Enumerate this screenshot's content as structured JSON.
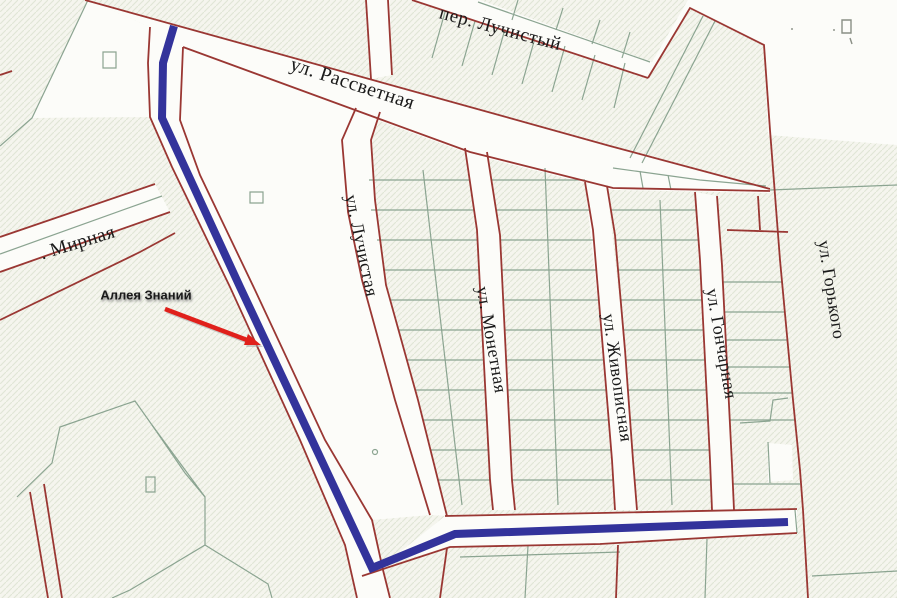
{
  "map": {
    "width": 897,
    "height": 598,
    "colors": {
      "background": "#f5f5ee",
      "hatch": "#e0e6d6",
      "parcel_fill": "#fcfcf9",
      "street_line": "#9a3733",
      "parcel_line": "#8ba491",
      "route": "#33339b",
      "arrow": "#e0201b",
      "arrow_shadow": "#a8a8a8",
      "label": "#1a1a1a"
    },
    "street_labels": [
      {
        "id": "per-luchistyy",
        "text": "пер. Лучистый",
        "x": 500,
        "y": 30,
        "rotation": 15,
        "size": 19
      },
      {
        "id": "ul-rassvetnaya",
        "text": "ул. Рассветная",
        "x": 352,
        "y": 85,
        "rotation": 18,
        "size": 20
      },
      {
        "id": "ul-mirnaya",
        "text": ". Мирная",
        "x": 78,
        "y": 244,
        "rotation": -17,
        "size": 19
      },
      {
        "id": "ul-luchistaya",
        "text": "ул. Лучистая",
        "x": 360,
        "y": 246,
        "rotation": 78,
        "size": 18
      },
      {
        "id": "ul-monetnaya",
        "text": "ул. Монетная",
        "x": 490,
        "y": 340,
        "rotation": 80,
        "size": 18
      },
      {
        "id": "ul-zhivopisnaya",
        "text": "ул. Живописная",
        "x": 616,
        "y": 378,
        "rotation": 82,
        "size": 18
      },
      {
        "id": "ul-goncharnaya",
        "text": "ул. Гончарная",
        "x": 720,
        "y": 344,
        "rotation": 80,
        "size": 18
      },
      {
        "id": "ul-gorkogo",
        "text": "ул. Горького",
        "x": 830,
        "y": 290,
        "rotation": 81,
        "size": 18
      }
    ],
    "annotation": {
      "text": "Аллея Знаний",
      "x": 146,
      "y": 296,
      "size": 13
    },
    "arrow": {
      "line": {
        "x1": 165,
        "y1": 309,
        "x2": 247,
        "y2": 340
      },
      "head": "261,345 244,345 248,334",
      "shadow_line": {
        "x1": 167,
        "y1": 311,
        "x2": 249,
        "y2": 342
      },
      "shadow_head": "263,347 246,347 250,336"
    },
    "route": {
      "name": "Аллея Знаний",
      "width": 8,
      "points": "174,26 163,63 162,118 240,287 312,440 372,568 455,534 788,522"
    },
    "white_areas": [
      "85,0 470,107 610,146 770,189 770,193 613,190 470,154 183,49 150,27 88,0",
      "150,27 148,63 150,117 172,167 230,287 300,440 345,545 357,598 390,598 383,570 372,520 325,440 255,290 200,175 180,120 183,47",
      "183,49 355,110 342,140 348,212 362,280 395,400 430,515 372,520 325,440 255,290 200,175 180,120",
      "356,108 380,112 371,140 375,200 386,285 418,400 447,516 430,515 395,400 362,280 348,212 342,140",
      "465,148 487,152 500,235 515,510 493,510 477,230",
      "585,182 607,186 625,350 637,510 615,510 603,350",
      "695,192 717,196 728,385 734,510 712,510 706,380",
      "652,62 688,0 897,0 897,145 768,135 764,45 690,8 648,78",
      "412,0 480,0 652,62 648,78",
      "445,516 600,513 797,509 797,533 720,537 600,544 450,547 385,565 375,572",
      "0,237 155,184 170,212 0,272",
      "88,0 150,27 148,63 150,117 32,118",
      "366,0 390,0 392,75 371,79",
      "768,443 792,445 793,480 768,482"
    ],
    "street_lines": [
      "M412,0 L648,78",
      "M648,78 L690,8 L764,45 L770,130 L780,260 L793,400 L800,470 L803,510 L808,598",
      "M85,0 L193,30 L470,107 L610,146 L770,189",
      "M183,47 L355,110 L470,152 L613,188 L770,191",
      "M150,27 L148,63 L150,117 L172,167 L230,287 L300,440 L345,545 L357,598",
      "M183,47 L180,120 L200,175 L255,290 L325,440 L372,520 L383,570 L390,598",
      "M356,108 L342,140 L348,212 L362,280 L395,400 L430,515",
      "M380,112 L371,140 L375,200 L386,285 L418,400 L447,516",
      "M465,148 L477,230 L490,480 L493,510",
      "M487,152 L500,235 L512,480 L515,510",
      "M585,182 L593,230 L603,350 L612,460 L615,510",
      "M607,186 L615,235 L625,350 L633,460 L637,510",
      "M695,192 L700,260 L706,380 L710,460 L712,510",
      "M717,196 L722,265 L728,385 L732,465 L734,510",
      "M445,516 L600,513 L797,509",
      "M362,576 L450,547 L600,544 L720,537 L797,533",
      "M0,237 L155,184",
      "M0,272 L170,212",
      "M0,320 L140,252 L175,233",
      "M727,230 L788,232 M758,196 L760,230",
      "M447,548 L440,598 M618,545 L616,598",
      "M30,492 L48,598 M44,484 L62,598",
      "M366,0 L371,79 M388,0 L392,75",
      "M0,75 L12,71"
    ],
    "parcel_lines": [
      "M88,0 L32,118 L0,146",
      "M103,52 h13 v16 h-13 Z",
      "M0,254 L162,196",
      "M445,12 L432,58 M475,21 L462,66 M505,29 L492,75 M535,38 L522,84 M565,46 L552,92 M595,55 L582,100 M625,63 L614,108",
      "M478,2 L650,62",
      "M518,0 L512,20 M563,8 L556,30 M600,20 L592,44 M630,32 L622,58",
      "M703,16 L630,158 M715,21 L642,163",
      "M613,168 L700,180 L766,186 M640,171 L643,188 M668,175 L671,190",
      "M770,190 L897,185",
      "M423,170 L462,505",
      "M369,180 L470,180 M371,210 L474,210 M377,240 L478,240 M383,270 L480,270 M390,300 L481,300 M398,330 L482,330 M407,360 L484,360 M415,390 L486,390 M423,420 L487,420 M430,450 L489,450 M438,480 L490,480",
      "M545,168 L558,505",
      "M492,180 L585,180 M496,210 L590,210 M500,240 L594,240 M502,270 L596,270 M503,300 L599,300 M505,330 L601,330 M506,360 L604,360 M508,390 L606,390 M509,420 L609,420 M511,450 L611,450 M512,480 L614,480",
      "M660,200 L672,505",
      "M611,210 L696,210 M615,240 L699,240 M618,270 L701,270 M621,300 L702,300 M623,330 L704,330 M626,360 L705,360 M628,390 L706,390 M630,420 L708,420 M632,450 L710,450 M634,480 L711,480",
      "M723,282 L782,282 M725,312 L785,312 M726,340 L787,340 M727,367 L790,367 M729,393 L792,393 M730,420 L795,420 M768,442 L770,483 M733,484 L800,484",
      "M740,423 L770,421 L773,400 L788,398",
      "M795,510 L797,533",
      "M528,546 L525,598 M707,539 L705,598 M812,576 L897,571",
      "M460,557 L620,552",
      "M17,497 L52,463 L60,427 L135,401 L152,425 L185,473 L205,497 L205,545 L130,590 L112,598",
      "M152,425 L205,497",
      "M146,477 h9 v15 h-9 Z",
      "M205,545 L268,584 L272,598",
      "M250,192 h13 v11 h-13 Z",
      "M372.5,452 a2.5,2.5 0 1 0 5,0 a2.5,2.5 0 1 0 -5,0"
    ],
    "specks": [
      "M842,20 h9 v13 h-9 Z",
      "M850,38 l2,6",
      "M791,29 h2",
      "M833,30 h2"
    ]
  }
}
